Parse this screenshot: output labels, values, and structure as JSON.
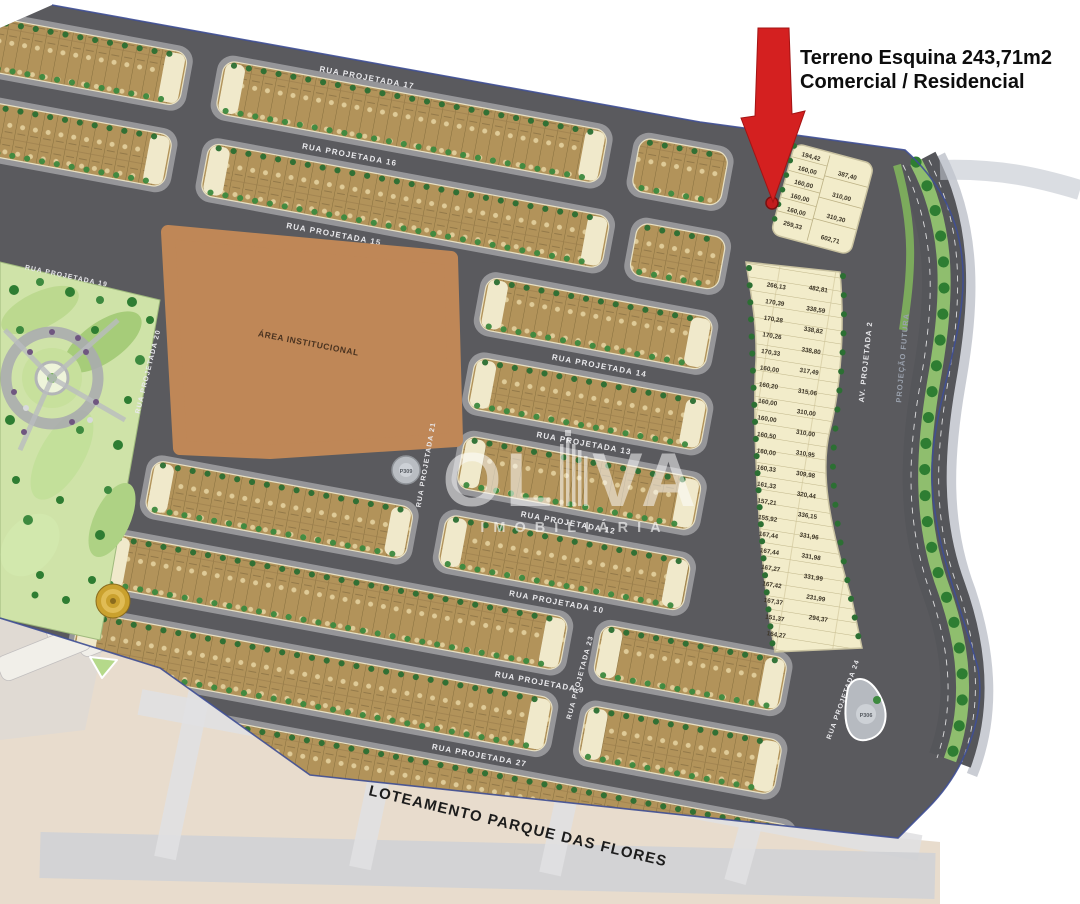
{
  "annotation": {
    "line1": "Terreno Esquina 243,71m2",
    "line2": "Comercial / Residencial"
  },
  "watermark": {
    "name": "OLIVA",
    "name_part1": "OL",
    "name_part2": "VA",
    "subtitle": "IMOBILIÁRIA"
  },
  "bottom_title": "LOTEAMENTO PARQUE DAS FLORES",
  "areas": {
    "institutional": "ÁREA INSTITUCIONAL"
  },
  "streets": {
    "horizontal": [
      {
        "label": "RUA PROJETADA 17"
      },
      {
        "label": "RUA PROJETADA 16"
      },
      {
        "label": "RUA PROJETADA 15"
      },
      {
        "label": "RUA PROJETADA 14"
      },
      {
        "label": "RUA PROJETADA 13"
      },
      {
        "label": "RUA PROJETADA 12"
      },
      {
        "label": "RUA PROJETADA 10"
      },
      {
        "label": "RUA PROJETADA 9"
      },
      {
        "label": "RUA PROJETADA 27"
      }
    ],
    "vertical": [
      {
        "label": "RUA PROJETADA 19"
      },
      {
        "label": "RUA PROJETADA 20"
      },
      {
        "label": "RUA PROJETADA 21"
      },
      {
        "label": "RUA PROJETADA 23"
      },
      {
        "label": "RUA PROJETADA 24"
      }
    ],
    "avenue": [
      {
        "label": "AV. PROJETADA 2"
      },
      {
        "label": "PROJEÇÃO FUTURA"
      }
    ]
  },
  "roundabouts": [
    "P309",
    "P306"
  ],
  "esquina_block": {
    "col1": [
      "194,42",
      "160,00",
      "160,00",
      "160,00",
      "160,00",
      "259,33"
    ],
    "col2": [
      "387,40",
      "310,00",
      "310,30",
      "602,71"
    ]
  },
  "right_block": {
    "col1": [
      "266,13",
      "170,39",
      "170,28",
      "170,26",
      "170,33",
      "160,00",
      "160,20",
      "160,00",
      "160,00",
      "160,50",
      "160,00",
      "160,33",
      "161,33",
      "157,21",
      "155,92",
      "167,44",
      "167,44",
      "167,27",
      "167,42",
      "167,37",
      "151,37",
      "164,27"
    ],
    "col2": [
      "482,81",
      "338,59",
      "338,82",
      "338,80",
      "317,49",
      "315,06",
      "310,00",
      "310,00",
      "310,95",
      "309,98",
      "320,44",
      "336,15",
      "331,96",
      "331,98",
      "331,99",
      "231,99",
      "294,37"
    ]
  },
  "colors": {
    "arrow_red": "#d42020",
    "road_gray": "#5a5a5e",
    "lot_tan": "#b2935a",
    "lot_cream": "#f2ecca",
    "tree_green": "#2c6f33",
    "park_green": "#cfe3a8",
    "institutional_brown": "#bf8757",
    "median_green": "#8fbe6e",
    "boundary_blue": "#3f4f95"
  }
}
